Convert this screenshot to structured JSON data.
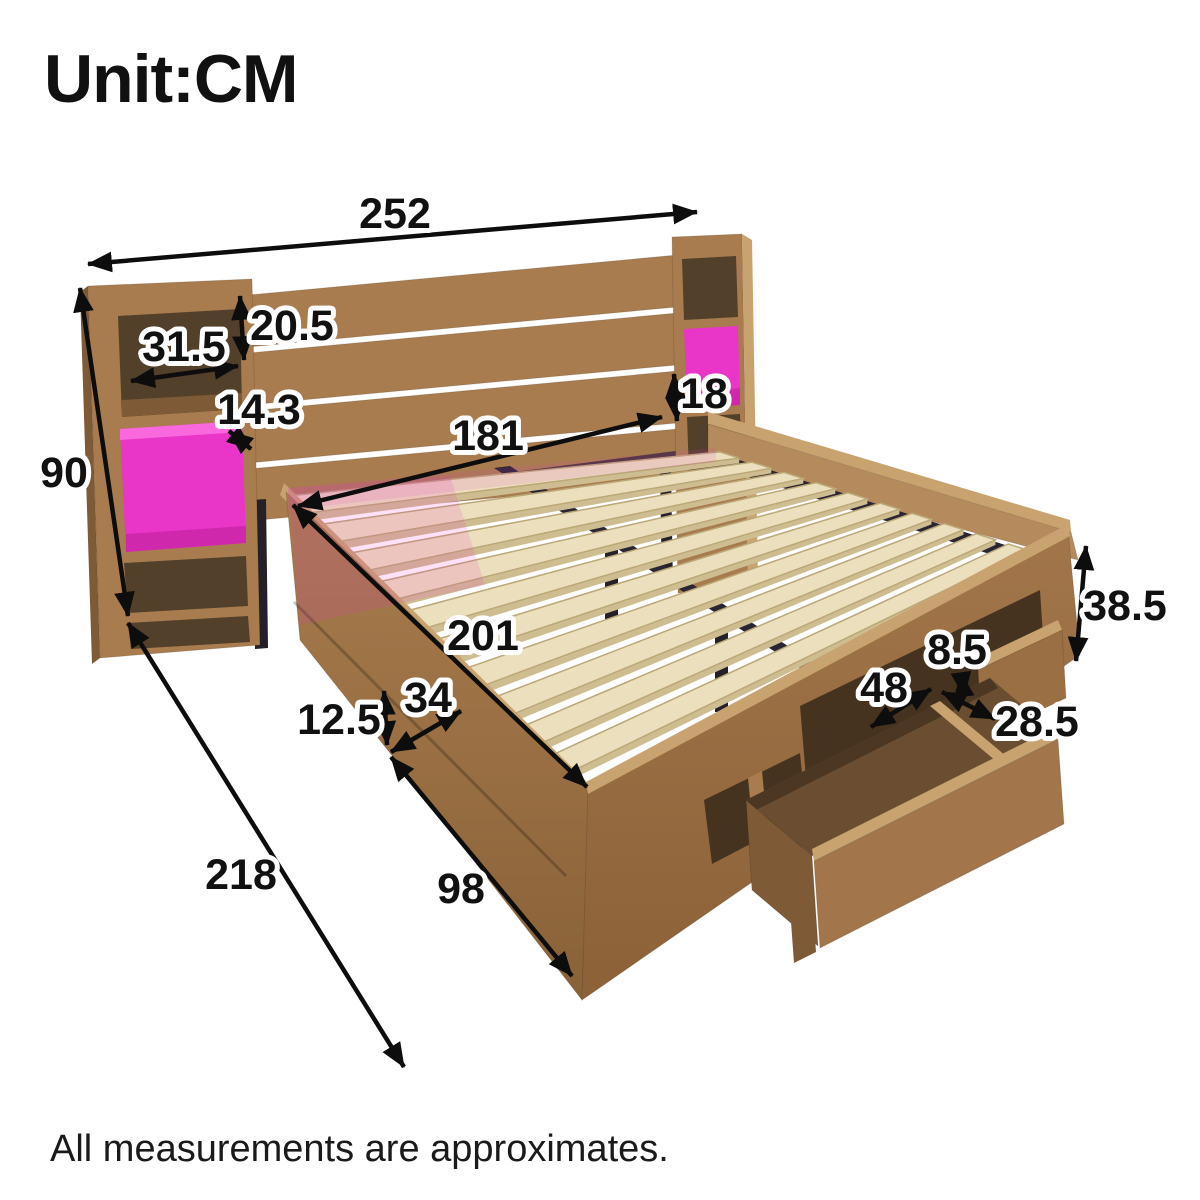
{
  "header": {
    "unit_label": "Unit:CM"
  },
  "footer": {
    "note": "All measurements are approximates."
  },
  "diagram": {
    "subject": "storage-bed-with-led-headboard-and-drawer",
    "unit": "cm",
    "colors": {
      "background": "#ffffff",
      "arrow": "#0d0d0d",
      "label_text": "#111111",
      "led_pink": "#e935c8",
      "led_pink_dark": "#cf28ad",
      "led_pink_light": "#f968dd",
      "wood_light": "#c9a36f",
      "wood_mid": "#a87c4e",
      "wood_band": "#b58a5c",
      "wood_shaded": "#96693e",
      "wood_dark": "#7e5a36",
      "wood_lip": "#9b6f44",
      "wood_interior": "#53402b",
      "wood_opening": "#46331f",
      "drawer_interior": "#6b4e31",
      "drawer_shadow": "#4c3722",
      "drawer_front": "#a2764a",
      "slat_cream": "#ebdfbd",
      "slat_edge": "#bba876",
      "slat_side": "#cfbd92",
      "metal_dark": "#2a2433",
      "frame_leg": "#241f28"
    },
    "dimensions": [
      {
        "id": "overall-width",
        "value": "252",
        "x1": 88,
        "y1": 264,
        "x2": 697,
        "y2": 212,
        "lx": 395,
        "ly": 214
      },
      {
        "id": "headboard-height",
        "value": "90",
        "x1": 80,
        "y1": 288,
        "x2": 128,
        "y2": 616,
        "lx": 64,
        "ly": 473
      },
      {
        "id": "shelf-width",
        "value": "31.5",
        "x1": 131,
        "y1": 381,
        "x2": 238,
        "y2": 366,
        "lx": 184,
        "ly": 347
      },
      {
        "id": "shelf-height",
        "value": "20.5",
        "x1": 240,
        "y1": 296,
        "x2": 244,
        "y2": 360,
        "lx": 292,
        "ly": 326
      },
      {
        "id": "shelf-depth",
        "value": "14.3",
        "x1": 229,
        "y1": 431,
        "x2": 251,
        "y2": 449,
        "lx": 259,
        "ly": 410
      },
      {
        "id": "headboard-clearance",
        "value": "18",
        "x1": 674,
        "y1": 374,
        "x2": 677,
        "y2": 421,
        "lx": 704,
        "ly": 394
      },
      {
        "id": "slat-area-width",
        "value": "181",
        "x1": 298,
        "y1": 506,
        "x2": 662,
        "y2": 417,
        "lx": 488,
        "ly": 436
      },
      {
        "id": "slat-area-length",
        "value": "201",
        "x1": 293,
        "y1": 505,
        "x2": 587,
        "y2": 787,
        "lx": 483,
        "ly": 636
      },
      {
        "id": "base-clearance",
        "value": "12.5",
        "x1": 384,
        "y1": 691,
        "x2": 387,
        "y2": 745,
        "lx": 339,
        "ly": 720
      },
      {
        "id": "side-rail-depth",
        "value": "34",
        "x1": 391,
        "y1": 752,
        "x2": 461,
        "y2": 711,
        "lx": 428,
        "ly": 698
      },
      {
        "id": "footboard-width",
        "value": "98",
        "x1": 391,
        "y1": 757,
        "x2": 572,
        "y2": 976,
        "lx": 461,
        "ly": 889
      },
      {
        "id": "overall-length",
        "value": "218",
        "x1": 128,
        "y1": 623,
        "x2": 404,
        "y2": 1067,
        "lx": 241,
        "ly": 875
      },
      {
        "id": "frame-height",
        "value": "38.5",
        "x1": 1086,
        "y1": 546,
        "x2": 1076,
        "y2": 661,
        "lx": 1125,
        "ly": 606
      },
      {
        "id": "drawer-rail-height",
        "value": "8.5",
        "x1": 961,
        "y1": 673,
        "x2": 964,
        "y2": 696,
        "lx": 957,
        "ly": 650
      },
      {
        "id": "drawer-length",
        "value": "48",
        "x1": 871,
        "y1": 727,
        "x2": 931,
        "y2": 689,
        "lx": 884,
        "ly": 688
      },
      {
        "id": "drawer-depth",
        "value": "28.5",
        "x1": 942,
        "y1": 692,
        "x2": 995,
        "y2": 719,
        "lx": 1037,
        "ly": 722
      }
    ]
  }
}
